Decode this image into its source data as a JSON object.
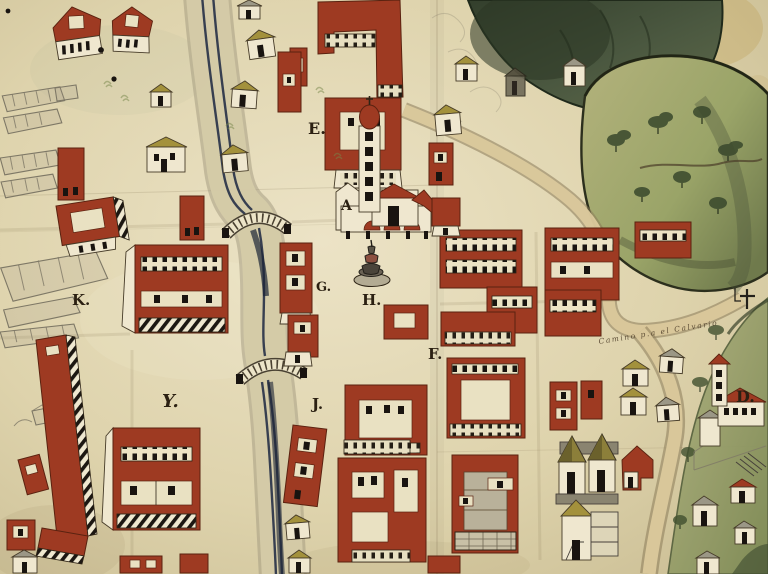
{
  "map": {
    "labels": {
      "E": "E.",
      "A": "A",
      "G": "G.",
      "H": "H.",
      "K": "K.",
      "Y": "Y.",
      "J": "J.",
      "F": "F.",
      "D": "D."
    },
    "inscription": "Camino p.a el Calvario",
    "marker": {
      "name": "calvary-cross",
      "glyph": "†"
    },
    "palette": {
      "paper": "#ddd2ab",
      "paper_light": "#eee6cb",
      "paper_shadow": "#c9bc92",
      "building_red": "#9e3a22",
      "building_red_dark": "#5a2210",
      "roof_olive": "#a3913c",
      "wall_white": "#efe7cf",
      "window_black": "#191410",
      "river_ink": "#273047",
      "hill_dark": "#3f4b37",
      "hill_olive": "#9aa468",
      "road_tan": "#dbc99c",
      "sketch_gray": "#7e7866",
      "label_ink": "#2b2012"
    }
  }
}
